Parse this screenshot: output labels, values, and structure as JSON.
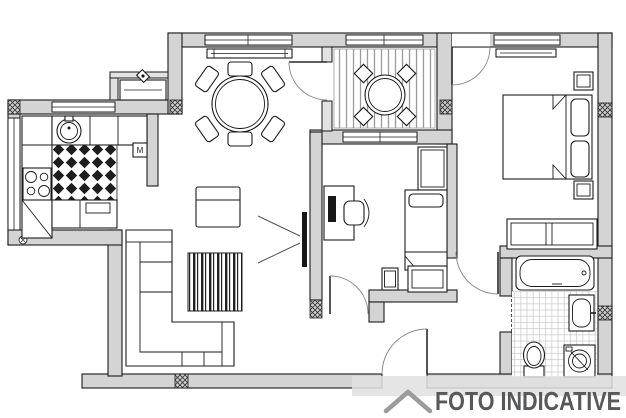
{
  "watermark": {
    "text": "FOTO INDICATIVE",
    "color": "#57585a",
    "logo": "roof-chevron-icon",
    "logo_color": "#9b9b9b"
  },
  "plan": {
    "kitchen": {
      "marker_label": "M"
    },
    "rooms": [
      "kitchen",
      "dining-living-room",
      "balcony",
      "small-bedroom",
      "master-bedroom",
      "bathroom",
      "hallway"
    ],
    "icons": [
      "window",
      "door",
      "radiator",
      "ac-unit",
      "column-hatch",
      "kitchen-sink",
      "stove",
      "kitchen-counter",
      "tile-floor",
      "dining-table",
      "dining-chair",
      "balcony-table",
      "balcony-chair",
      "sofa",
      "armchair",
      "rug",
      "tv",
      "desk",
      "monitor",
      "office-chair",
      "single-bed",
      "wardrobe",
      "dresser",
      "double-bed",
      "pillow",
      "nightstand",
      "bathtub",
      "washbasin",
      "toilet",
      "washing-machine",
      "entrance-door"
    ]
  },
  "colors": {
    "wall_fill": "#d4d4d4",
    "line": "#1b1b1b",
    "balcony_stripe": "#9a9a9a",
    "bath_tile": "#c8c8c8",
    "watermark_band": "#e0e0e0"
  }
}
